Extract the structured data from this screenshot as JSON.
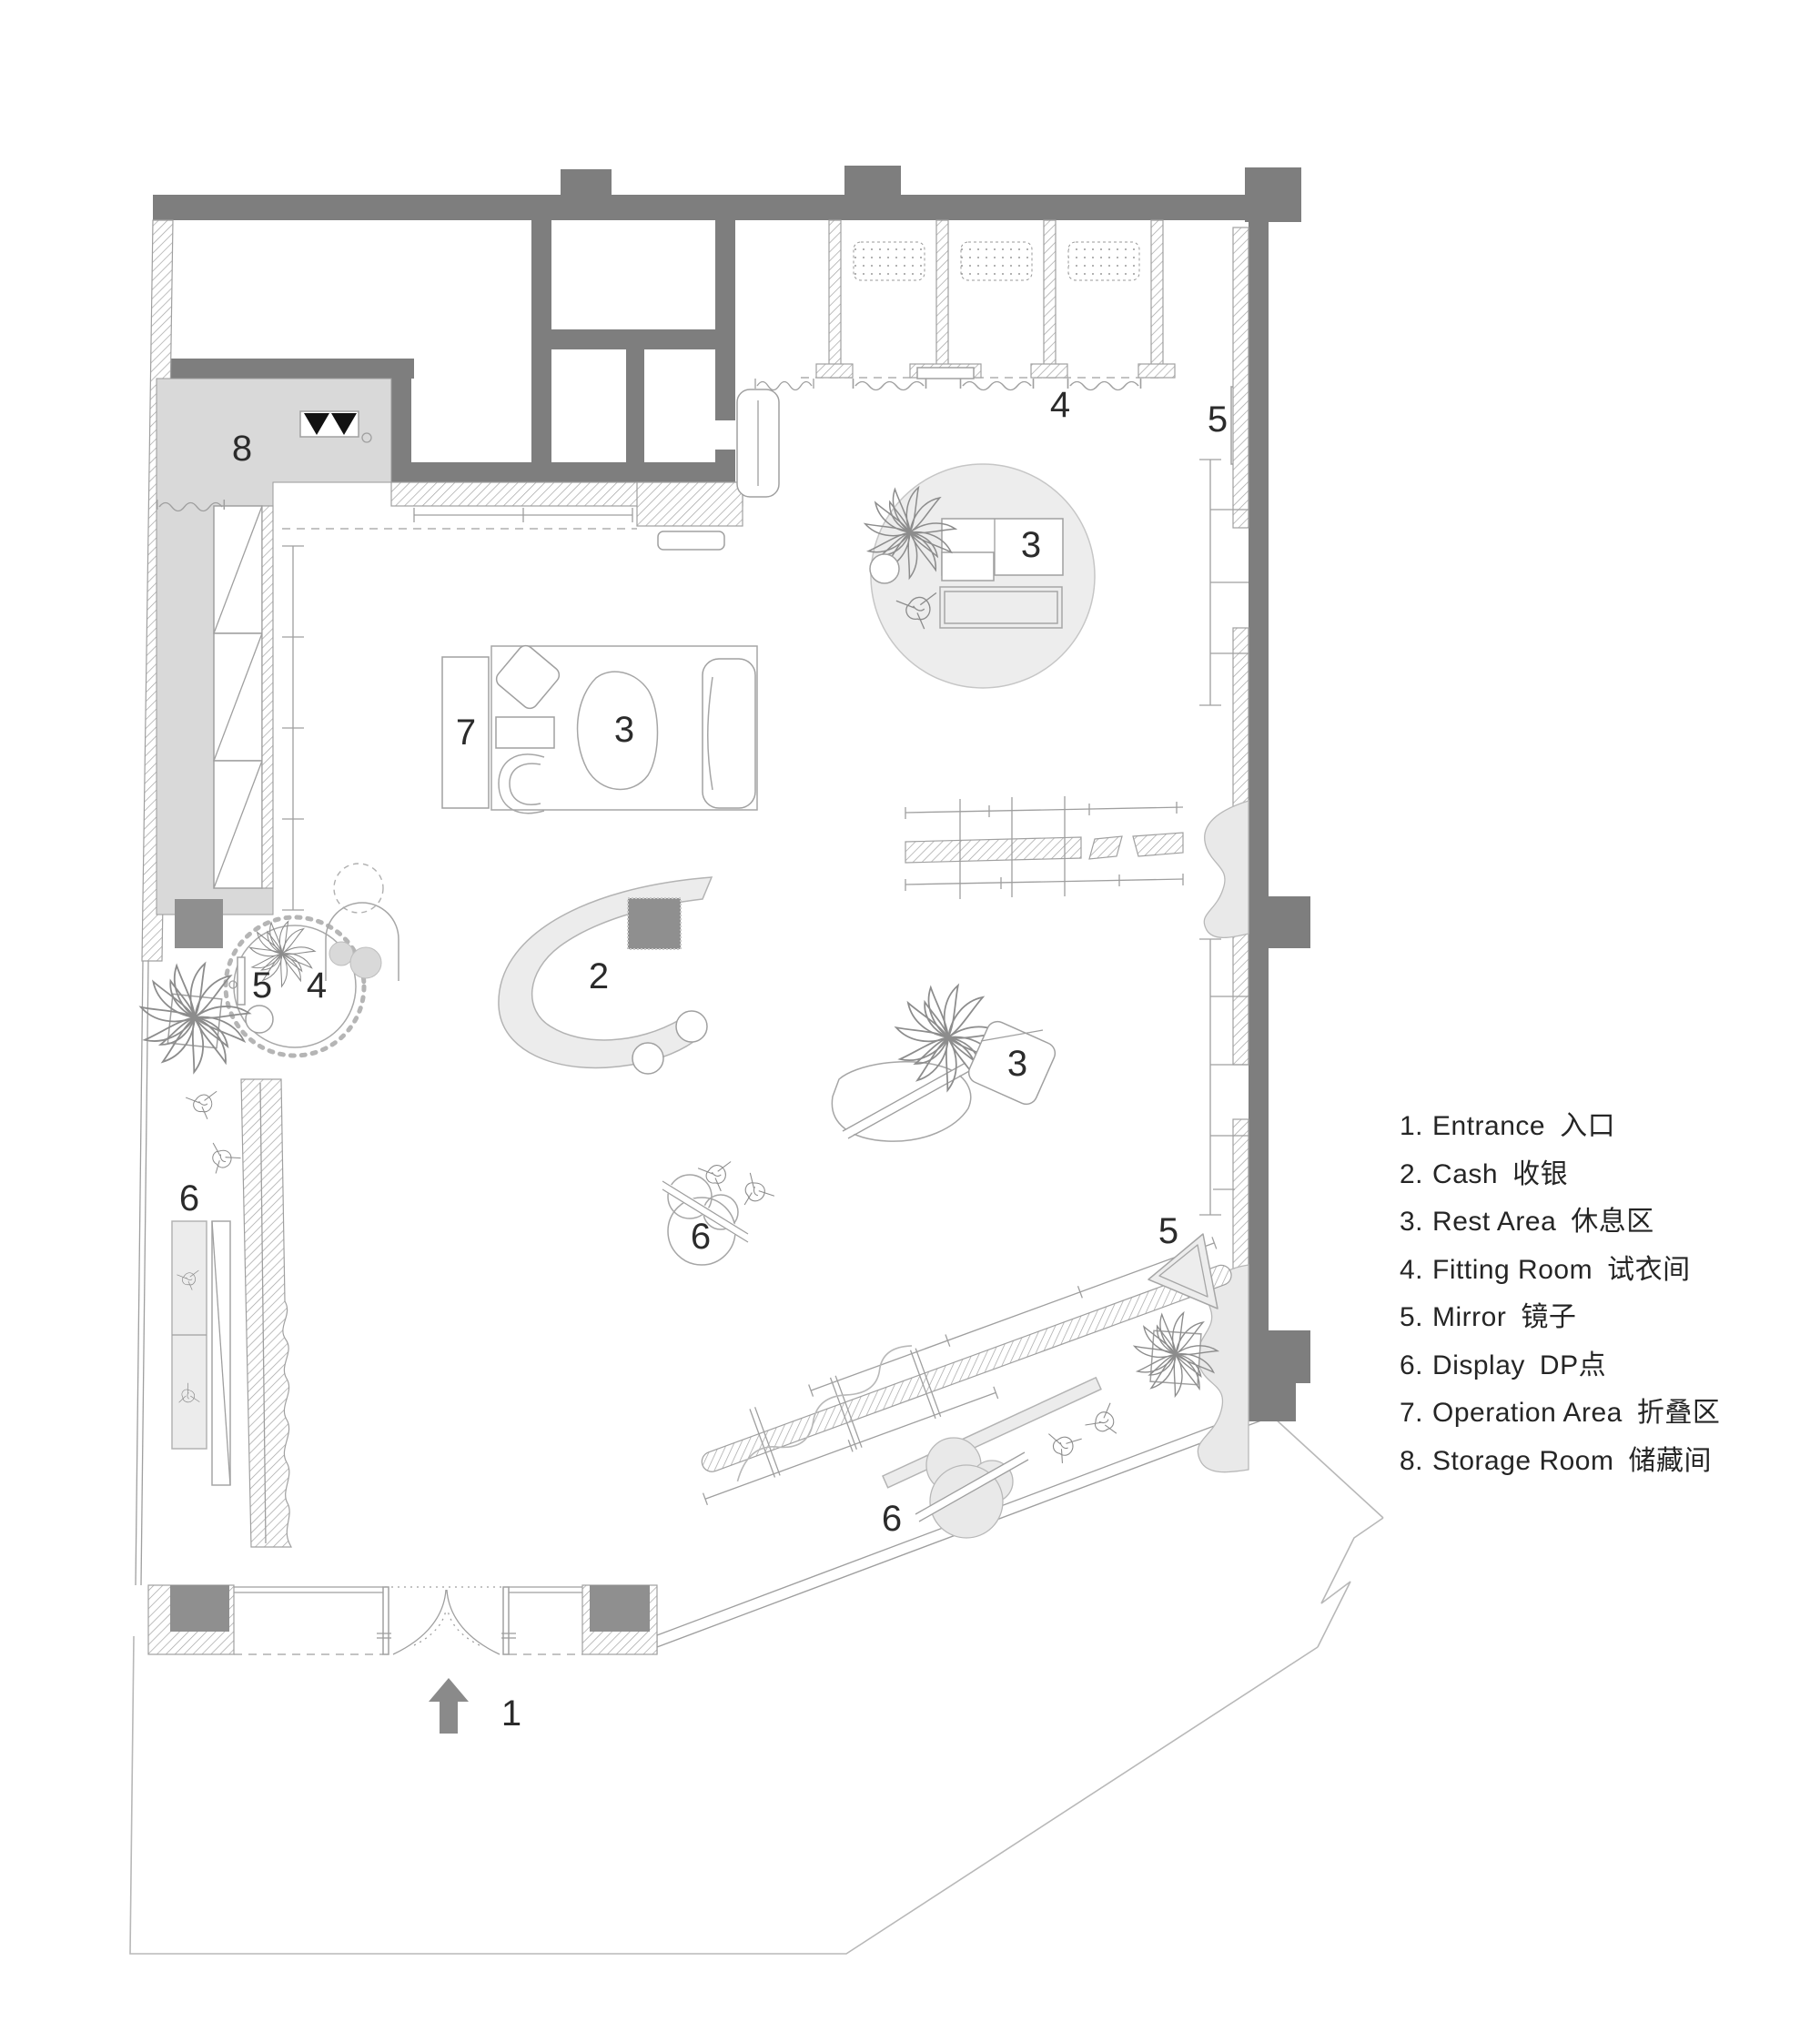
{
  "legend": {
    "items": [
      {
        "num": "1.",
        "en": "Entrance",
        "zh": "入口"
      },
      {
        "num": "2.",
        "en": "Cash",
        "zh": "收银"
      },
      {
        "num": "3.",
        "en": "Rest Area",
        "zh": "休息区"
      },
      {
        "num": "4.",
        "en": "Fitting Room",
        "zh": "试衣间"
      },
      {
        "num": "5.",
        "en": "Mirror",
        "zh": "镜子"
      },
      {
        "num": "6.",
        "en": "Display",
        "zh": "DP点"
      },
      {
        "num": "7.",
        "en": "Operation Area",
        "zh": "折叠区"
      },
      {
        "num": "8.",
        "en": "Storage Room",
        "zh": "储藏间"
      }
    ]
  },
  "plan_labels": {
    "storage_room": "8",
    "fitting_room_top": "4",
    "mirror_top": "5",
    "rest_area_circle": "3",
    "operation_area": "7",
    "rest_area_mid": "3",
    "mirror_round": "5",
    "fitting_round": "4",
    "cash": "2",
    "rest_area_blob": "3",
    "display_left": "6",
    "display_center": "6",
    "mirror_triangle": "5",
    "display_bottom": "6",
    "entrance": "1"
  },
  "colors": {
    "wall_gray": "#7e7e7e",
    "column_dark": "#8f8f8f",
    "storage_fill": "#d9d9d9",
    "furniture_fill": "#ececec",
    "line_gray": "#a6a6a6",
    "text": "#2b2b2b",
    "door_triangle_black": "#111111"
  }
}
